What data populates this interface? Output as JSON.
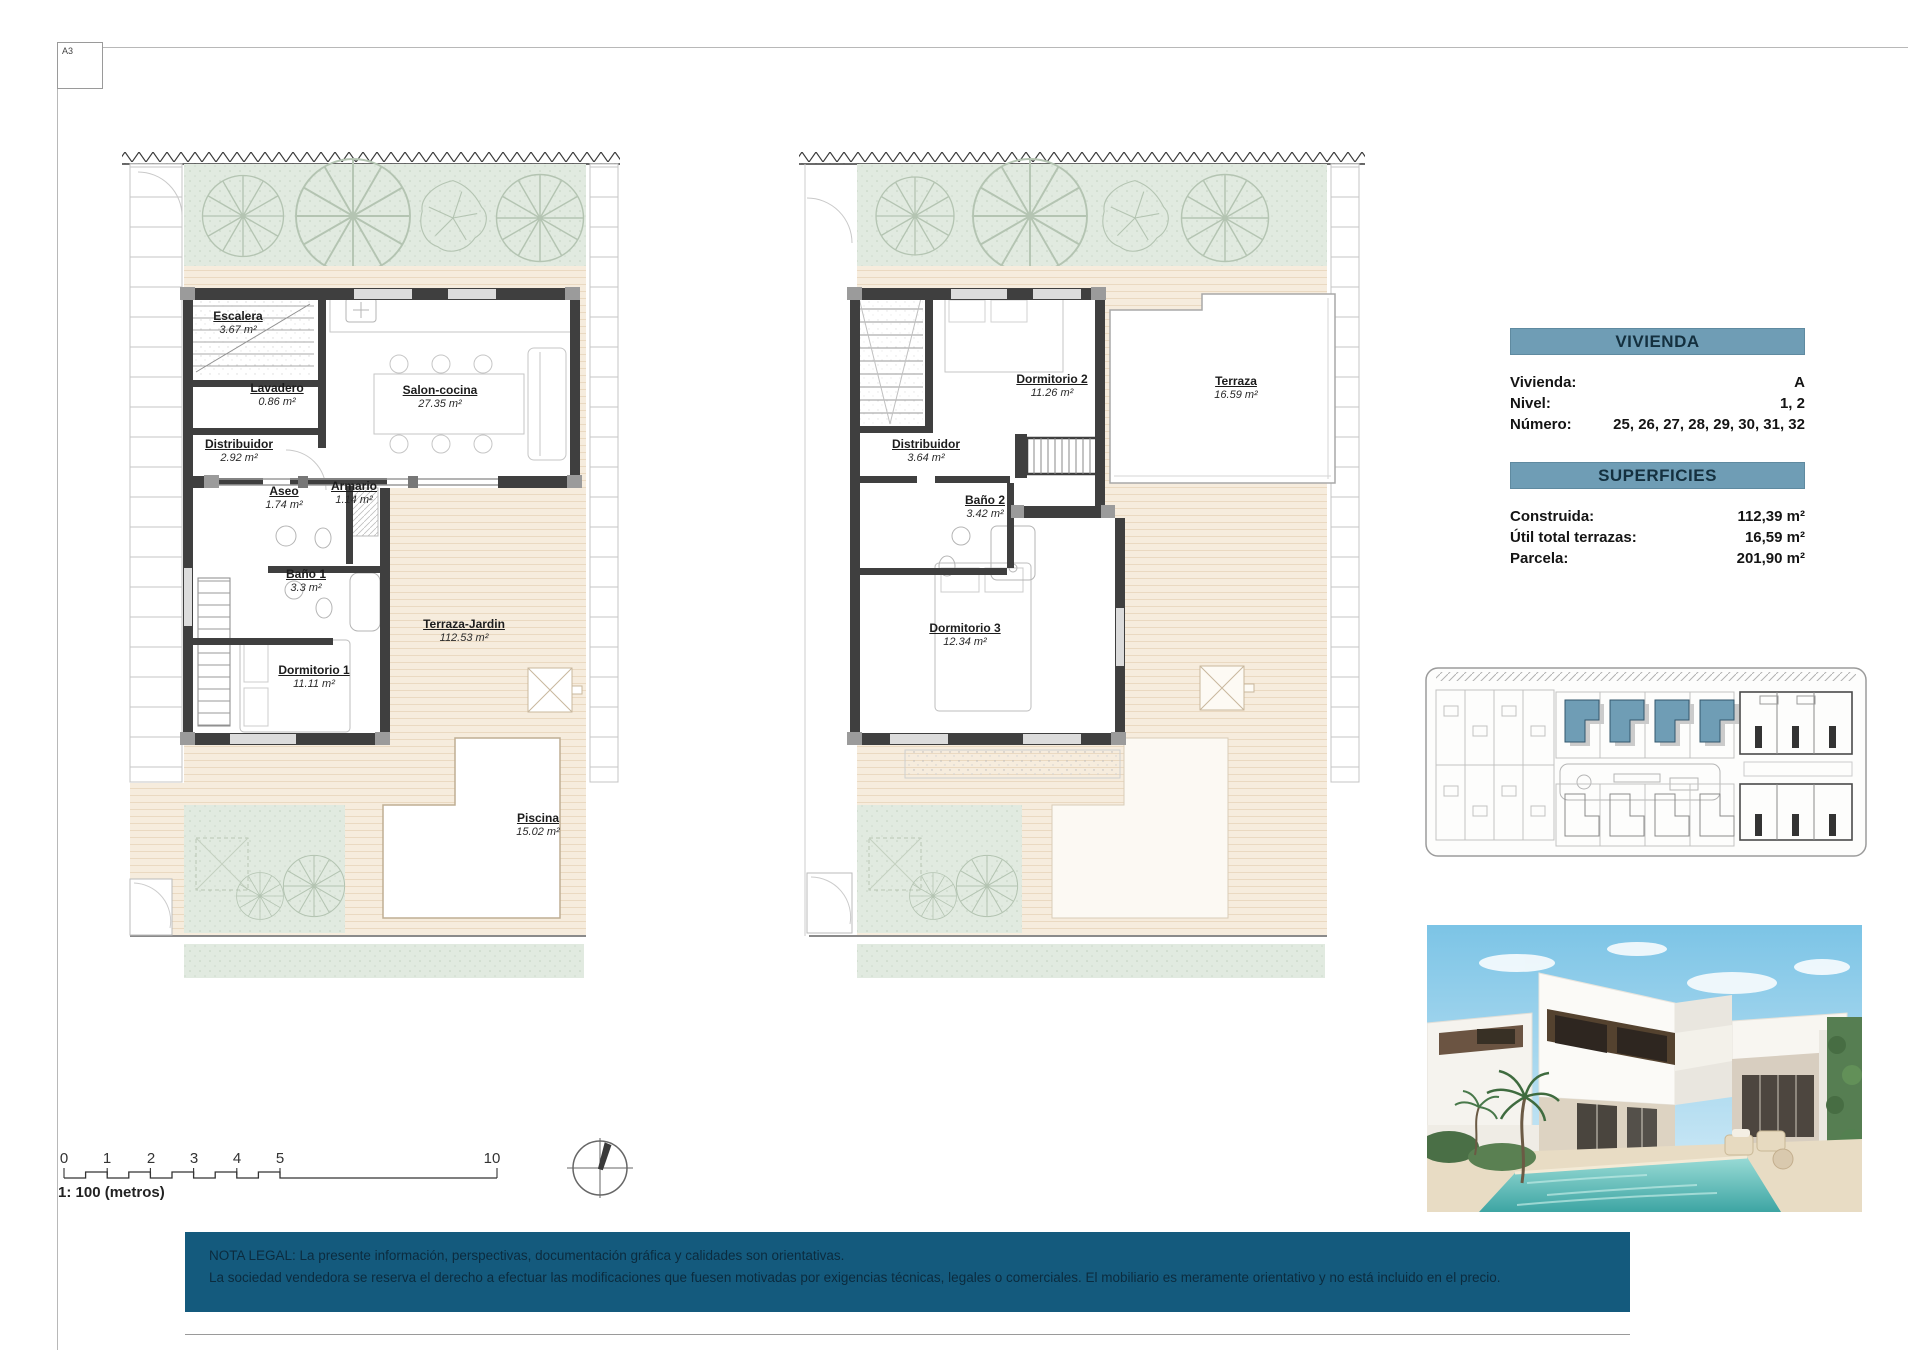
{
  "page": {
    "sheet_label": "A3"
  },
  "plans": [
    {
      "name": "planta-baja",
      "rooms": [
        {
          "name": "Escalera",
          "area": "3.67 m²"
        },
        {
          "name": "Lavadero",
          "area": "0.86 m²"
        },
        {
          "name": "Salon-cocina",
          "area": "27.35 m²"
        },
        {
          "name": "Distribuidor",
          "area": "2.92 m²"
        },
        {
          "name": "Aseo",
          "area": "1.74 m²"
        },
        {
          "name": "Armario",
          "area": "1.14 m²"
        },
        {
          "name": "Baño 1",
          "area": "3.3 m²"
        },
        {
          "name": "Terraza-Jardin",
          "area": "112.53 m²"
        },
        {
          "name": "Dormitorio 1",
          "area": "11.11 m²"
        },
        {
          "name": "Piscina",
          "area": "15.02 m²"
        }
      ]
    },
    {
      "name": "planta-primera",
      "rooms": [
        {
          "name": "Dormitorio 2",
          "area": "11.26 m²"
        },
        {
          "name": "Terraza",
          "area": "16.59 m²"
        },
        {
          "name": "Distribuidor",
          "area": "3.64 m²"
        },
        {
          "name": "Baño 2",
          "area": "3.42 m²"
        },
        {
          "name": "Dormitorio 3",
          "area": "12.34 m²"
        }
      ]
    }
  ],
  "vivienda_panel": {
    "title": "VIVIENDA",
    "rows": [
      {
        "label": "Vivienda:",
        "value": "A"
      },
      {
        "label": "Nivel:",
        "value": "1, 2"
      },
      {
        "label": "Número:",
        "value": "25, 26, 27, 28, 29, 30, 31, 32"
      }
    ]
  },
  "superficies_panel": {
    "title": "SUPERFICIES",
    "rows": [
      {
        "label": "Construida:",
        "value": "112,39 m²"
      },
      {
        "label": "Útil total terrazas:",
        "value": "16,59 m²"
      },
      {
        "label": "Parcela:",
        "value": "201,90 m²"
      }
    ]
  },
  "scale_bar": {
    "ticks": [
      "0",
      "1",
      "2",
      "3",
      "4",
      "5",
      "10"
    ],
    "caption": "1: 100 (metros)"
  },
  "legal": {
    "line1": "NOTA LEGAL: La presente información, perspectivas, documentación gráfica y calidades son orientativas.",
    "line2": "La sociedad vendedora se reserva el derecho a efectuar las modificaciones que fuesen motivadas por exigencias técnicas, legales o comerciales. El mobiliario es meramente orientativo y no está incluido en el precio."
  },
  "colors": {
    "panel_header": "#6f9db5",
    "legal_background": "#145a7d",
    "site_highlight": "#6f9db5",
    "garden_green": "#e1eae0",
    "terrace_beige": "#f6ecdd",
    "pool_water": "#3ea5a3",
    "wall_dark": "#3f3f3f"
  }
}
